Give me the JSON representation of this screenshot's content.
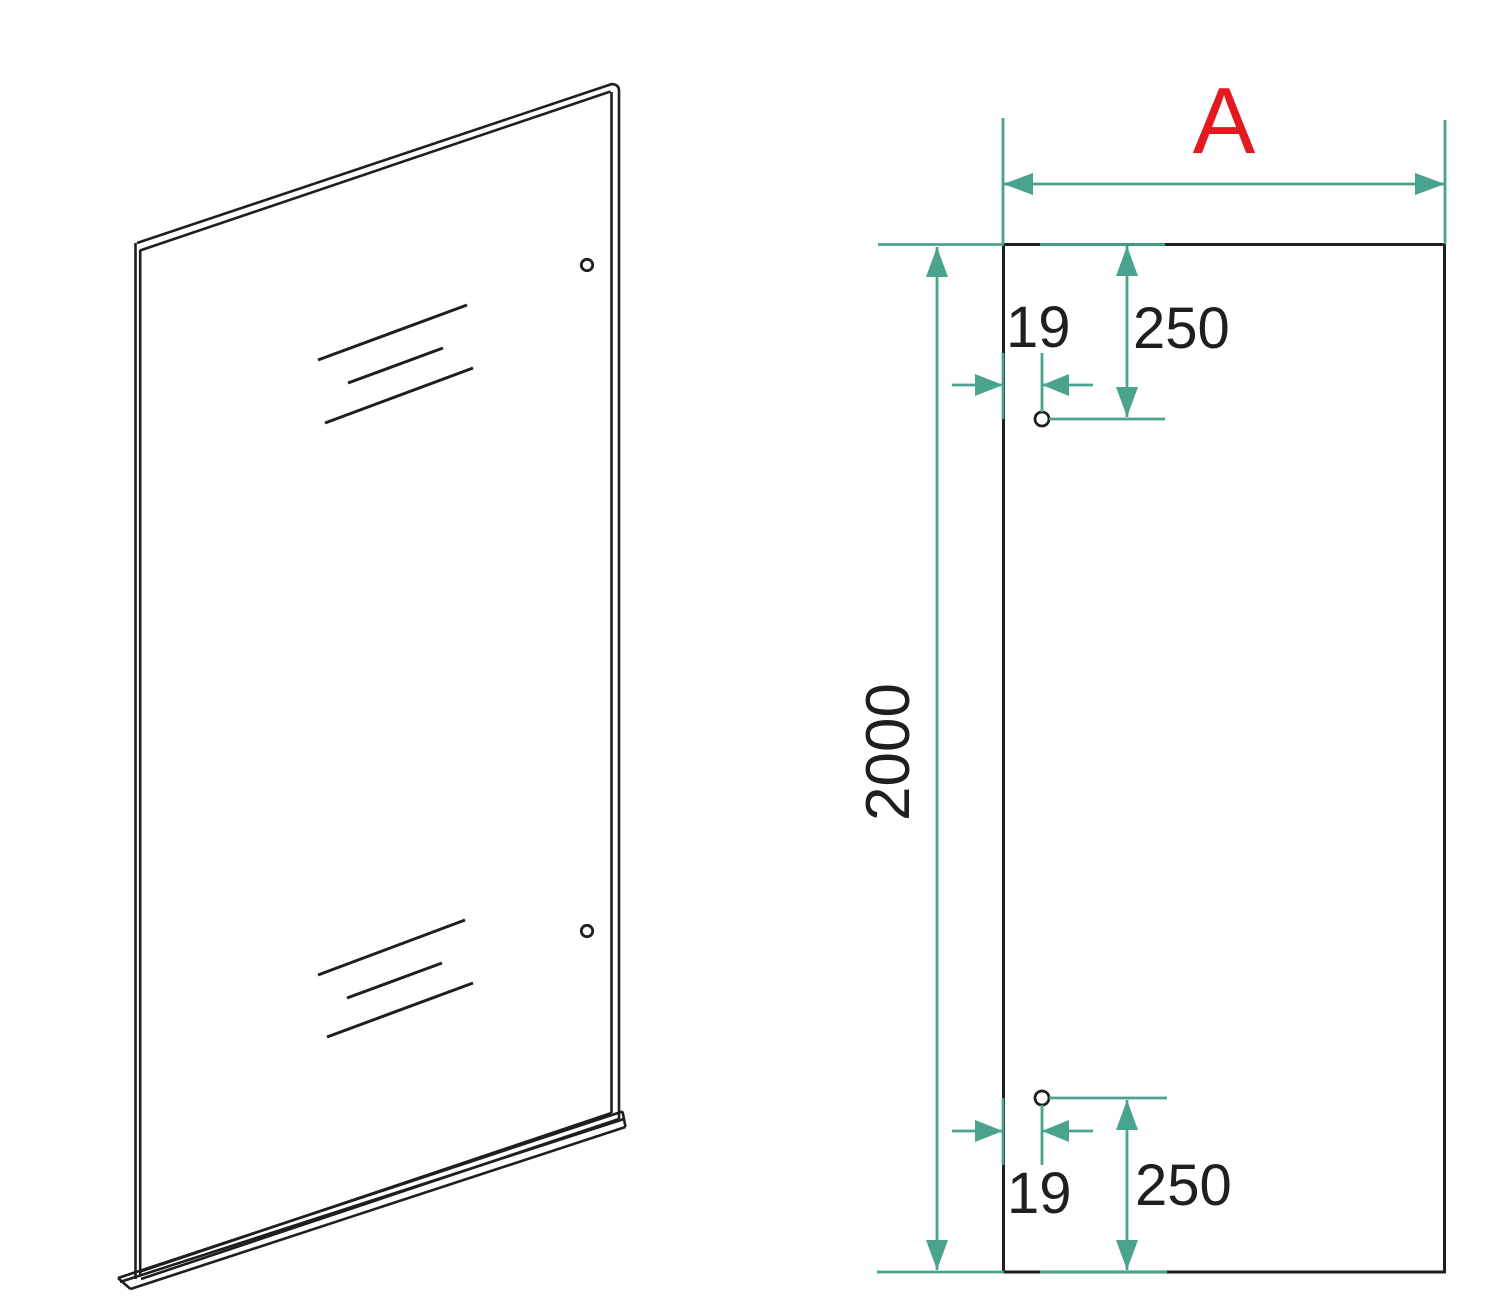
{
  "colors": {
    "background": "#ffffff",
    "line": "#1f1f1f",
    "dimension": "#4aa38c",
    "accent": "#e2191e"
  },
  "dimensions": {
    "width_label": "A",
    "height": "2000",
    "top_hole": {
      "edge_offset": "19",
      "top_offset": "250"
    },
    "bottom_hole": {
      "edge_offset": "19",
      "bottom_offset": "250"
    }
  }
}
